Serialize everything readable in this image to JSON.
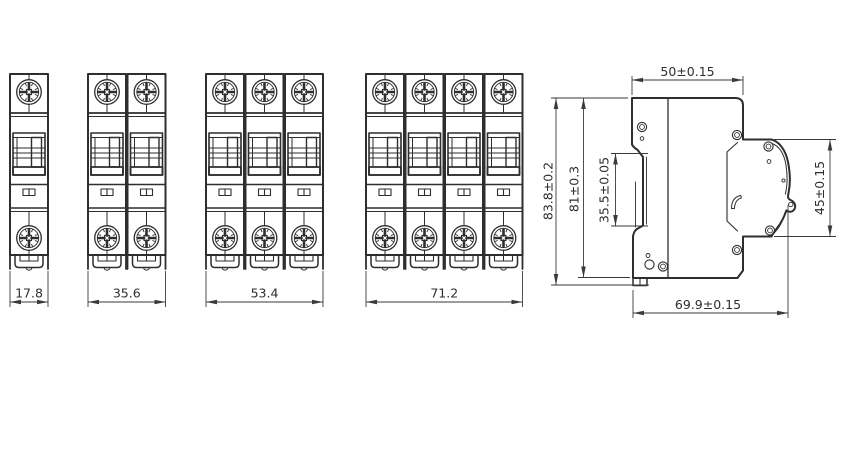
{
  "drawing": {
    "front_views": [
      {
        "id": "1-pole",
        "poles": 1,
        "width_label": "17.8"
      },
      {
        "id": "2-pole",
        "poles": 2,
        "width_label": "35.6"
      },
      {
        "id": "3-pole",
        "poles": 3,
        "width_label": "53.4"
      },
      {
        "id": "4-pole",
        "poles": 4,
        "width_label": "71.2"
      }
    ],
    "side_view": {
      "labels": {
        "top_width": "50±0.15",
        "overall_height": "83.8±0.2",
        "body_height": "81±0.3",
        "din_recess_height": "35.5±0.05",
        "front_face_height": "45±0.15",
        "depth": "69.9±0.15"
      }
    },
    "colors": {
      "line": "#2e2e2e",
      "dimension": "#3a3a3a",
      "background": "#ffffff"
    }
  }
}
